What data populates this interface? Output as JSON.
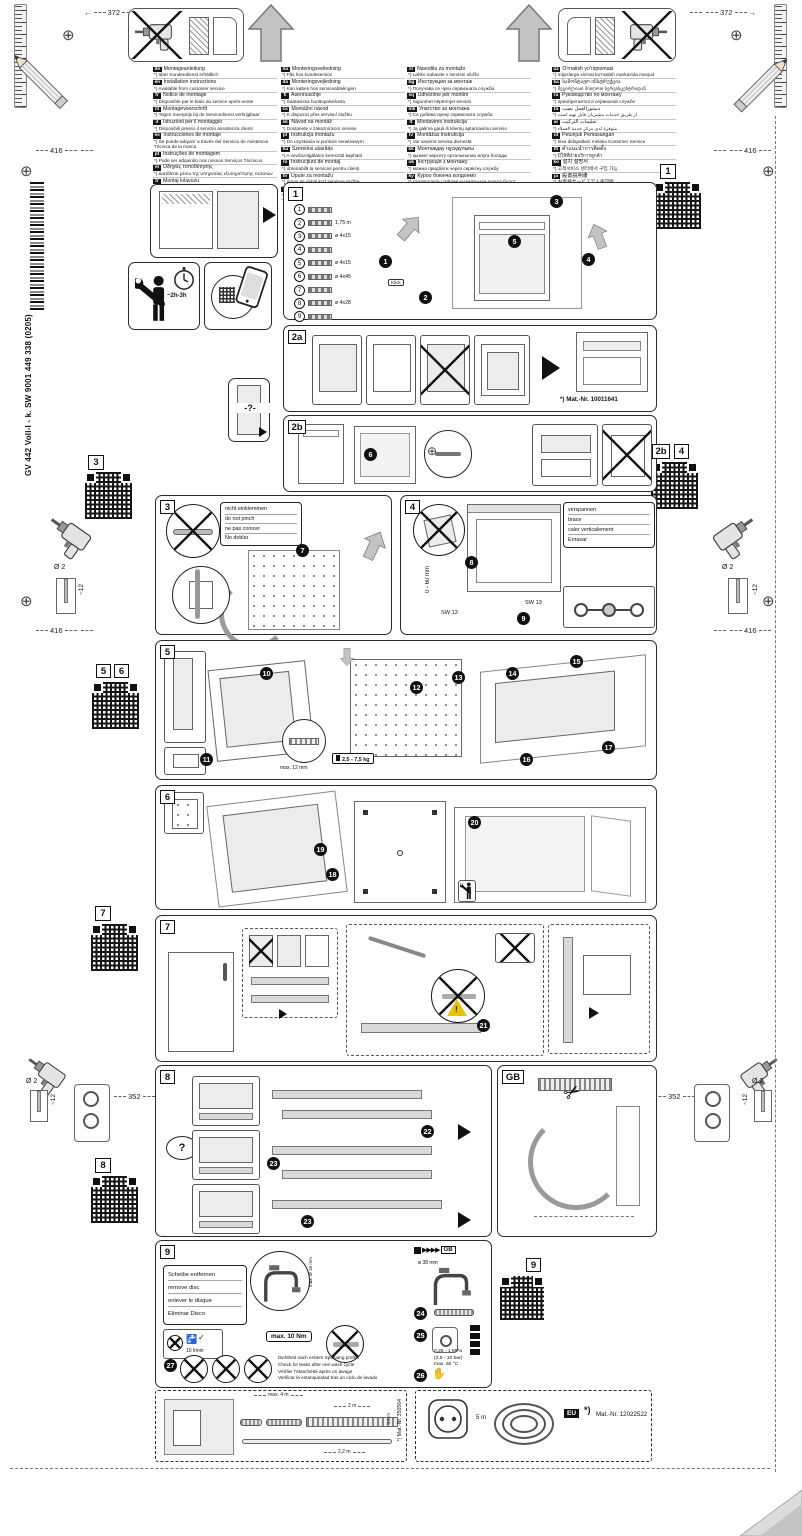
{
  "meta": {
    "spine_text": "GV 442 Voll-I - k. SW  9001 449 338 (0205)"
  },
  "top": {
    "dim_left": "372",
    "dim_right": "372"
  },
  "margins": {
    "left": {
      "p3": "3",
      "p5": "5",
      "p6": "6",
      "p7": "7",
      "p8": "8",
      "dim_416_top": "416",
      "dim_416_bottom": "416",
      "dim_352": "352",
      "drill_dia": "Ø 2",
      "drill_depth": "~12"
    },
    "right": {
      "p1": "1",
      "p2b": "2b",
      "p4": "4",
      "p9": "9",
      "dim_416_top": "416",
      "dim_416_bottom": "416",
      "dim_352": "352",
      "drill_dia": "Ø 2",
      "drill_depth": "~12"
    }
  },
  "languages": {
    "col1": [
      {
        "code": "de",
        "l1": "Montageanleitung",
        "l2": "*) über Kundendienst erhältlich"
      },
      {
        "code": "en",
        "l1": "Installation instructions",
        "l2": "*) Available from customer service"
      },
      {
        "code": "fr",
        "l1": "Notice de montage",
        "l2": "*) Disponible par le biais du service après-vente"
      },
      {
        "code": "nl",
        "l1": "Montagevoorschrift",
        "l2": "*) Tegen meerprijs bij de Servicedienst verkrijgbaar"
      },
      {
        "code": "it",
        "l1": "Istruzioni per il montaggio",
        "l2": "*) Disponibili presso il servizio assistenza clienti"
      },
      {
        "code": "es",
        "l1": "Instrucciones de montaje",
        "l2": "*) Se puede adquirir a través del Servicio de Asistencia Técnica de la marca"
      },
      {
        "code": "pt",
        "l1": "Instruções de montagem",
        "l2": "*) Pode ser adquirido nos nossos Serviços Técnicos"
      },
      {
        "code": "el",
        "l1": "Οδηγίες τοποθέτησης",
        "l2": "*) Διατίθεται μέσω της υπηρεσίας εξυπηρέτησης πελατών"
      },
      {
        "code": "tr",
        "l1": "Montaj kılavuzu",
        "l2": "*) Yetkili servis üzerinden temin edilebilir"
      },
      {
        "code": "sv",
        "l1": "Monteringsanvisning",
        "l2": "*) Fås via kundservice"
      }
    ],
    "col2": [
      {
        "code": "no",
        "l1": "Monteringsveiledning",
        "l2": "*) Fås hos kundeservice"
      },
      {
        "code": "da",
        "l1": "Monteringsvejledning",
        "l2": "*) Kan købes hos serviceafdelingen"
      },
      {
        "code": "fi",
        "l1": "Asennusohje",
        "l2": "*) Saatavissa huoltopalvelusta"
      },
      {
        "code": "cs",
        "l1": "Montážní návod",
        "l2": "*) K dispozici přes servisní službu"
      },
      {
        "code": "sk",
        "l1": "Návod na montáž",
        "l2": "*) Dostanete v zákazníckom servise"
      },
      {
        "code": "pl",
        "l1": "Instrukcja montażu",
        "l2": "*) Do uzyskania w punkcie serwisowym"
      },
      {
        "code": "hu",
        "l1": "Szerelési utasítás",
        "l2": "*) A vevőszolgálaton keresztül kapható"
      },
      {
        "code": "ro",
        "l1": "Instrucţiuni de montaj",
        "l2": "*) obtenabilă la serviciul pentru clienţi"
      },
      {
        "code": "hr",
        "l1": "Upute za montažu",
        "l2": "*) mogu se dobiti kod servisne službe"
      },
      {
        "code": "sr",
        "l1": "Uputstvo za montažu",
        "l2": "*) Može se nabaviti preko korisničke službe"
      }
    ],
    "col3": [
      {
        "code": "sl",
        "l1": "Navodila za montažo",
        "l2": "*) Lahko nabavite v servisni službi"
      },
      {
        "code": "bg",
        "l1": "Инструкция за монтаж",
        "l2": "*) Получава се чрез сервизната служба"
      },
      {
        "code": "sq",
        "l1": "Udhëzime për montim",
        "l2": "*) Sigurohet nëpërmjet servisit"
      },
      {
        "code": "mk",
        "l1": "Упатство за монтажа",
        "l2": "*) Се добива преку сервисната служба"
      },
      {
        "code": "lt",
        "l1": "Montavimo instrukcija",
        "l2": "*) Ją galima gauti iš klientų aptarnavimo serviso"
      },
      {
        "code": "lv",
        "l1": "Montāžas instrukcija",
        "l2": "*) Var saņemt servisa dienestā"
      },
      {
        "code": "kk",
        "l1": "Монтаждау нұсқаулығы",
        "l2": "*) қызмет көрсету орталығынан алуға болады"
      },
      {
        "code": "uk",
        "l1": "Інструкція з монтажу",
        "l2": "*) можна придбати через сервісну службу"
      },
      {
        "code": "ky",
        "l1": "Куроо боюнча колдонмо",
        "l2": "*) кардарларды тейлөө кызматынан алууга болот"
      },
      {
        "code": "vi",
        "l1": "Hướng dẫn lắp đặt",
        "l2": "*) Có sẵn từ dịch vụ khách hàng"
      }
    ],
    "col4": [
      {
        "code": "uz",
        "l1": "O'rnatish yo'riqnomasi",
        "l2": "*) mijozlarga xizmat ko'rsatish markazida mavjud"
      },
      {
        "code": "ka",
        "l1": "სამონტაჟო ინსტრუქცია",
        "l2": "*) შეგიძლიათ მიიღოთ სერვისცენტრიდან"
      },
      {
        "code": "ru",
        "l1": "Руководство по монтажу",
        "l2": "*) приобретается в сервисной службе"
      },
      {
        "code": "fa",
        "l1": "دستورالعمل نصب",
        "l2": "*) از طریق خدمات مشتریان قابل تهیه است"
      },
      {
        "code": "ar",
        "l1": "تعليمات التركيب",
        "l2": "*) متوفرة لدى مركز خدمة العملاء"
      },
      {
        "code": "id",
        "l1": "Petunjuk Pemasangan",
        "l2": "*) bisa didapatkan melalui Customer Service"
      },
      {
        "code": "th",
        "l1": "คำแนะนำการติดตั้ง",
        "l2": "*) มีให้ที่ฝ่ายบริการลูกค้า"
      },
      {
        "code": "ko",
        "l1": "설치 설명서",
        "l2": "*) 고객서비스 센터에서 구입 가능"
      },
      {
        "code": "ja",
        "l1": "設置説明書",
        "l2": "*) お客様サービスで入手可能"
      },
      {
        "code": "zh",
        "l1": "安装说明",
        "l2": "*) 可向售后服务部门购买"
      }
    ]
  },
  "prep": {
    "time": "~2h-3h",
    "door_q": "-?-"
  },
  "panel1": {
    "badge": "1",
    "klick": "Klick",
    "steps": [
      "1",
      "2",
      "3",
      "4",
      "5"
    ],
    "parts": [
      {
        "num": "1",
        "label": ""
      },
      {
        "num": "2",
        "label": "1,75 m"
      },
      {
        "num": "3",
        "label": "ø 4x15"
      },
      {
        "num": "4",
        "label": ""
      },
      {
        "num": "5",
        "label": "ø 4x15"
      },
      {
        "num": "6",
        "label": "ø 4x45"
      },
      {
        "num": "7",
        "label": ""
      },
      {
        "num": "8",
        "label": "ø 4x28"
      },
      {
        "num": "9",
        "label": ""
      }
    ]
  },
  "panel2a": {
    "badge": "2a",
    "mat_nr": "*) Mat.-Nr. 10011641"
  },
  "panel2b": {
    "badge": "2b",
    "step": "6"
  },
  "panel3": {
    "badge": "3",
    "step": "7",
    "warn": [
      "nicht einklemmen",
      "do not pinch",
      "ne pas coincer",
      "No doblar"
    ]
  },
  "panel4": {
    "badge": "4",
    "step_a": "8",
    "step_b": "9",
    "dim": "0 - 60 mm",
    "sw": "SW 13",
    "warn": [
      "verspannen",
      "brace",
      "caler verticalement",
      "Enrasar"
    ]
  },
  "panel5": {
    "badge": "5",
    "steps": [
      "10",
      "11",
      "12",
      "13",
      "14",
      "15",
      "16",
      "17"
    ],
    "max12": "max. 12 mm",
    "weight": "2,5 - 7,5 kg"
  },
  "panel6": {
    "badge": "6",
    "steps": [
      "18",
      "19",
      "20"
    ]
  },
  "panel7": {
    "badge": "7",
    "step": "21"
  },
  "panel8": {
    "badge": "8",
    "q": "?",
    "step22": "22",
    "step23": "23"
  },
  "panelGB": {
    "badge": "GB"
  },
  "panel9": {
    "badge": "9",
    "disc": [
      "Scheibe entfernen",
      "remove disc",
      "enlever le disque",
      "Eliminar Disco"
    ],
    "aerator": "max. Ø 18 mm",
    "flow": "10 l/min",
    "torque": "max. 10 Nm",
    "gb": "GB",
    "dia": "ø 38 mm",
    "s24": "24",
    "s25": "25",
    "s26": "26",
    "s27": "27",
    "pressure": [
      "0,25 - 1 MPa",
      "(2,5 - 10 bar)",
      "max. 60 °C"
    ],
    "leak": [
      "Dichtheit nach erstem Spülgang prüfen",
      "Check for leaks after one wash cycle",
      "Vérifier l'étanchéité après un lavage",
      "Verificar la estanqueidad tras un ciclo de lavado"
    ]
  },
  "bottom_left": {
    "max4": "max. 4 m",
    "d2": "2 m",
    "d22": "2,2 m",
    "d05": "0,5 m",
    "mat": "*) Mat.-Nr. 350564"
  },
  "bottom_right": {
    "len": "5 m",
    "eu": "EU",
    "star": "*)",
    "mat": "Mat.-Nr. 12022522"
  }
}
